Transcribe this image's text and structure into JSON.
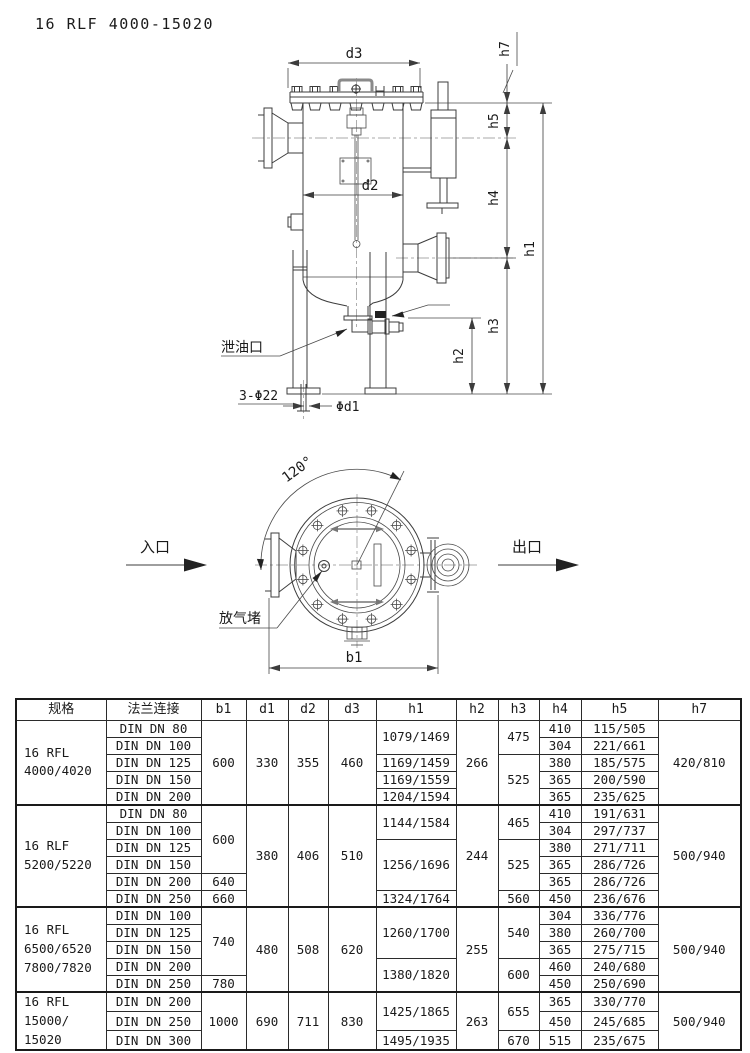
{
  "page": {
    "title": "16 RLF 4000-15020"
  },
  "side": {
    "d3": "d3",
    "d2": "d2",
    "h1": "h1",
    "h2": "h2",
    "h3": "h3",
    "h4": "h4",
    "h5": "h5",
    "h7": "h7",
    "drain": "泄油口",
    "holes": "3-Φ22",
    "d1": "Φd1"
  },
  "top": {
    "angle": "120°",
    "inlet": "入口",
    "outlet": "出口",
    "vent": "放气堵",
    "b1": "b1"
  },
  "table": {
    "columns": [
      "规格",
      "法兰连接",
      "b1",
      "d1",
      "d2",
      "d3",
      "h1",
      "h2",
      "h3",
      "h4",
      "h5",
      "h7"
    ],
    "groups": [
      {
        "spec": [
          "16 RFL",
          "4000/4020"
        ],
        "flanges": [
          "DIN DN 80",
          "DIN DN 100",
          "DIN DN 125",
          "DIN DN 150",
          "DIN DN 200"
        ],
        "cells": {
          "b1": [
            [
              "600",
              5
            ]
          ],
          "d1": [
            [
              "330",
              5
            ]
          ],
          "d2": [
            [
              "355",
              5
            ]
          ],
          "d3": [
            [
              "460",
              5
            ]
          ],
          "h1": [
            [
              "1079/1469",
              2
            ],
            [
              "1169/1459",
              1
            ],
            [
              "1169/1559",
              1
            ],
            [
              "1204/1594",
              1
            ]
          ],
          "h2": [
            [
              "266",
              5
            ]
          ],
          "h3": [
            [
              "475",
              2
            ],
            [
              "525",
              3
            ]
          ],
          "h4": [
            [
              "410",
              1
            ],
            [
              "304",
              1
            ],
            [
              "380",
              1
            ],
            [
              "365",
              1
            ],
            [
              "365",
              1
            ]
          ],
          "h5": [
            [
              "115/505",
              1
            ],
            [
              "221/661",
              1
            ],
            [
              "185/575",
              1
            ],
            [
              "200/590",
              1
            ],
            [
              "235/625",
              1
            ]
          ],
          "h7": [
            [
              "420/810",
              5
            ]
          ]
        }
      },
      {
        "spec": [
          "16 RLF",
          "5200/5220"
        ],
        "flanges": [
          "DIN DN 80",
          "DIN DN 100",
          "DIN DN 125",
          "DIN DN 150",
          "DIN DN 200",
          "DIN DN 250"
        ],
        "cells": {
          "b1": [
            [
              "600",
              4
            ],
            [
              "640",
              1
            ],
            [
              "660",
              1
            ]
          ],
          "d1": [
            [
              "380",
              6
            ]
          ],
          "d2": [
            [
              "406",
              6
            ]
          ],
          "d3": [
            [
              "510",
              6
            ]
          ],
          "h1": [
            [
              "1144/1584",
              2
            ],
            [
              "1256/1696",
              3
            ],
            [
              "1324/1764",
              1
            ]
          ],
          "h2": [
            [
              "244",
              6
            ]
          ],
          "h3": [
            [
              "465",
              2
            ],
            [
              "525",
              3
            ],
            [
              "560",
              1
            ]
          ],
          "h4": [
            [
              "410",
              1
            ],
            [
              "304",
              1
            ],
            [
              "380",
              1
            ],
            [
              "365",
              1
            ],
            [
              "365",
              1
            ],
            [
              "450",
              1
            ]
          ],
          "h5": [
            [
              "191/631",
              1
            ],
            [
              "297/737",
              1
            ],
            [
              "271/711",
              1
            ],
            [
              "286/726",
              1
            ],
            [
              "286/726",
              1
            ],
            [
              "236/676",
              1
            ]
          ],
          "h7": [
            [
              "500/940",
              6
            ]
          ]
        }
      },
      {
        "spec": [
          "16 RFL",
          "6500/6520",
          "7800/7820"
        ],
        "flanges": [
          "DIN DN 100",
          "DIN DN 125",
          "DIN DN 150",
          "DIN DN 200",
          "DIN DN 250"
        ],
        "cells": {
          "b1": [
            [
              "740",
              4
            ],
            [
              "780",
              1
            ]
          ],
          "d1": [
            [
              "480",
              5
            ]
          ],
          "d2": [
            [
              "508",
              5
            ]
          ],
          "d3": [
            [
              "620",
              5
            ]
          ],
          "h1": [
            [
              "1260/1700",
              3
            ],
            [
              "1380/1820",
              2
            ]
          ],
          "h2": [
            [
              "255",
              5
            ]
          ],
          "h3": [
            [
              "540",
              3
            ],
            [
              "600",
              2
            ]
          ],
          "h4": [
            [
              "304",
              1
            ],
            [
              "380",
              1
            ],
            [
              "365",
              1
            ],
            [
              "460",
              1
            ],
            [
              "450",
              1
            ]
          ],
          "h5": [
            [
              "336/776",
              1
            ],
            [
              "260/700",
              1
            ],
            [
              "275/715",
              1
            ],
            [
              "240/680",
              1
            ],
            [
              "250/690",
              1
            ]
          ],
          "h7": [
            [
              "500/940",
              5
            ]
          ]
        }
      },
      {
        "spec": [
          "16 RFL",
          "15000/",
          "15020"
        ],
        "flanges": [
          "DIN DN 200",
          "DIN DN 250",
          "DIN DN 300"
        ],
        "cells": {
          "b1": [
            [
              "1000",
              3
            ]
          ],
          "d1": [
            [
              "690",
              3
            ]
          ],
          "d2": [
            [
              "711",
              3
            ]
          ],
          "d3": [
            [
              "830",
              3
            ]
          ],
          "h1": [
            [
              "1425/1865",
              2
            ],
            [
              "1495/1935",
              1
            ]
          ],
          "h2": [
            [
              "263",
              3
            ]
          ],
          "h3": [
            [
              "655",
              2
            ],
            [
              "670",
              1
            ]
          ],
          "h4": [
            [
              "365",
              1
            ],
            [
              "450",
              1
            ],
            [
              "515",
              1
            ]
          ],
          "h5": [
            [
              "330/770",
              1
            ],
            [
              "245/685",
              1
            ],
            [
              "235/675",
              1
            ]
          ],
          "h7": [
            [
              "500/940",
              3
            ]
          ]
        }
      }
    ]
  }
}
